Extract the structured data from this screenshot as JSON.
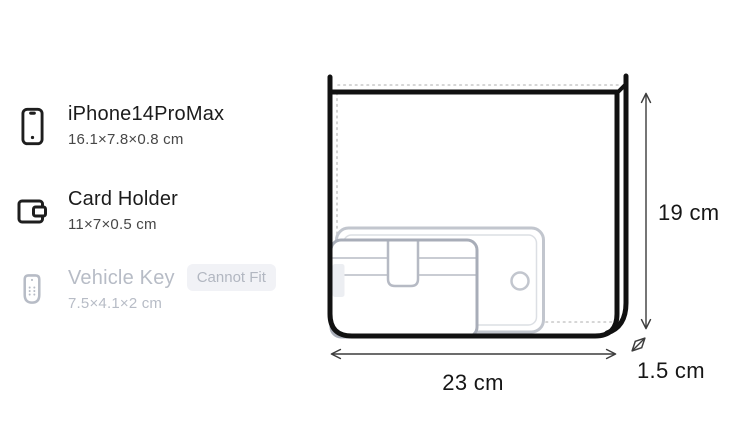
{
  "item_list": {
    "items": [
      {
        "name": "iPhone14ProMax",
        "dimensions": "16.1×7.8×0.8 cm",
        "icon": "smartphone-icon",
        "can_fit": true
      },
      {
        "name": "Card Holder",
        "dimensions": "11×7×0.5 cm",
        "icon": "card-holder-icon",
        "can_fit": true
      },
      {
        "name": "Vehicle Key",
        "dimensions": "7.5×4.1×2 cm",
        "icon": "vehicle-key-icon",
        "can_fit": false,
        "badge": "Cannot Fit"
      }
    ]
  },
  "diagram": {
    "bag": {
      "width_label": "23 cm",
      "height_label": "19 cm",
      "depth_label": "1.5 cm"
    },
    "ghost_items": [
      "card-holder",
      "smartphone"
    ]
  },
  "colors": {
    "text_primary": "#1b1b1b",
    "text_secondary": "#474747",
    "text_disabled": "#b7bcc6",
    "badge_bg": "#f1f2f6",
    "badge_text": "#b2b7c1",
    "bag_outline": "#111111",
    "ghost_outline": "#b6bac4",
    "dotted_line": "#c8c8c8",
    "dimension_line": "#3c3c3c"
  }
}
